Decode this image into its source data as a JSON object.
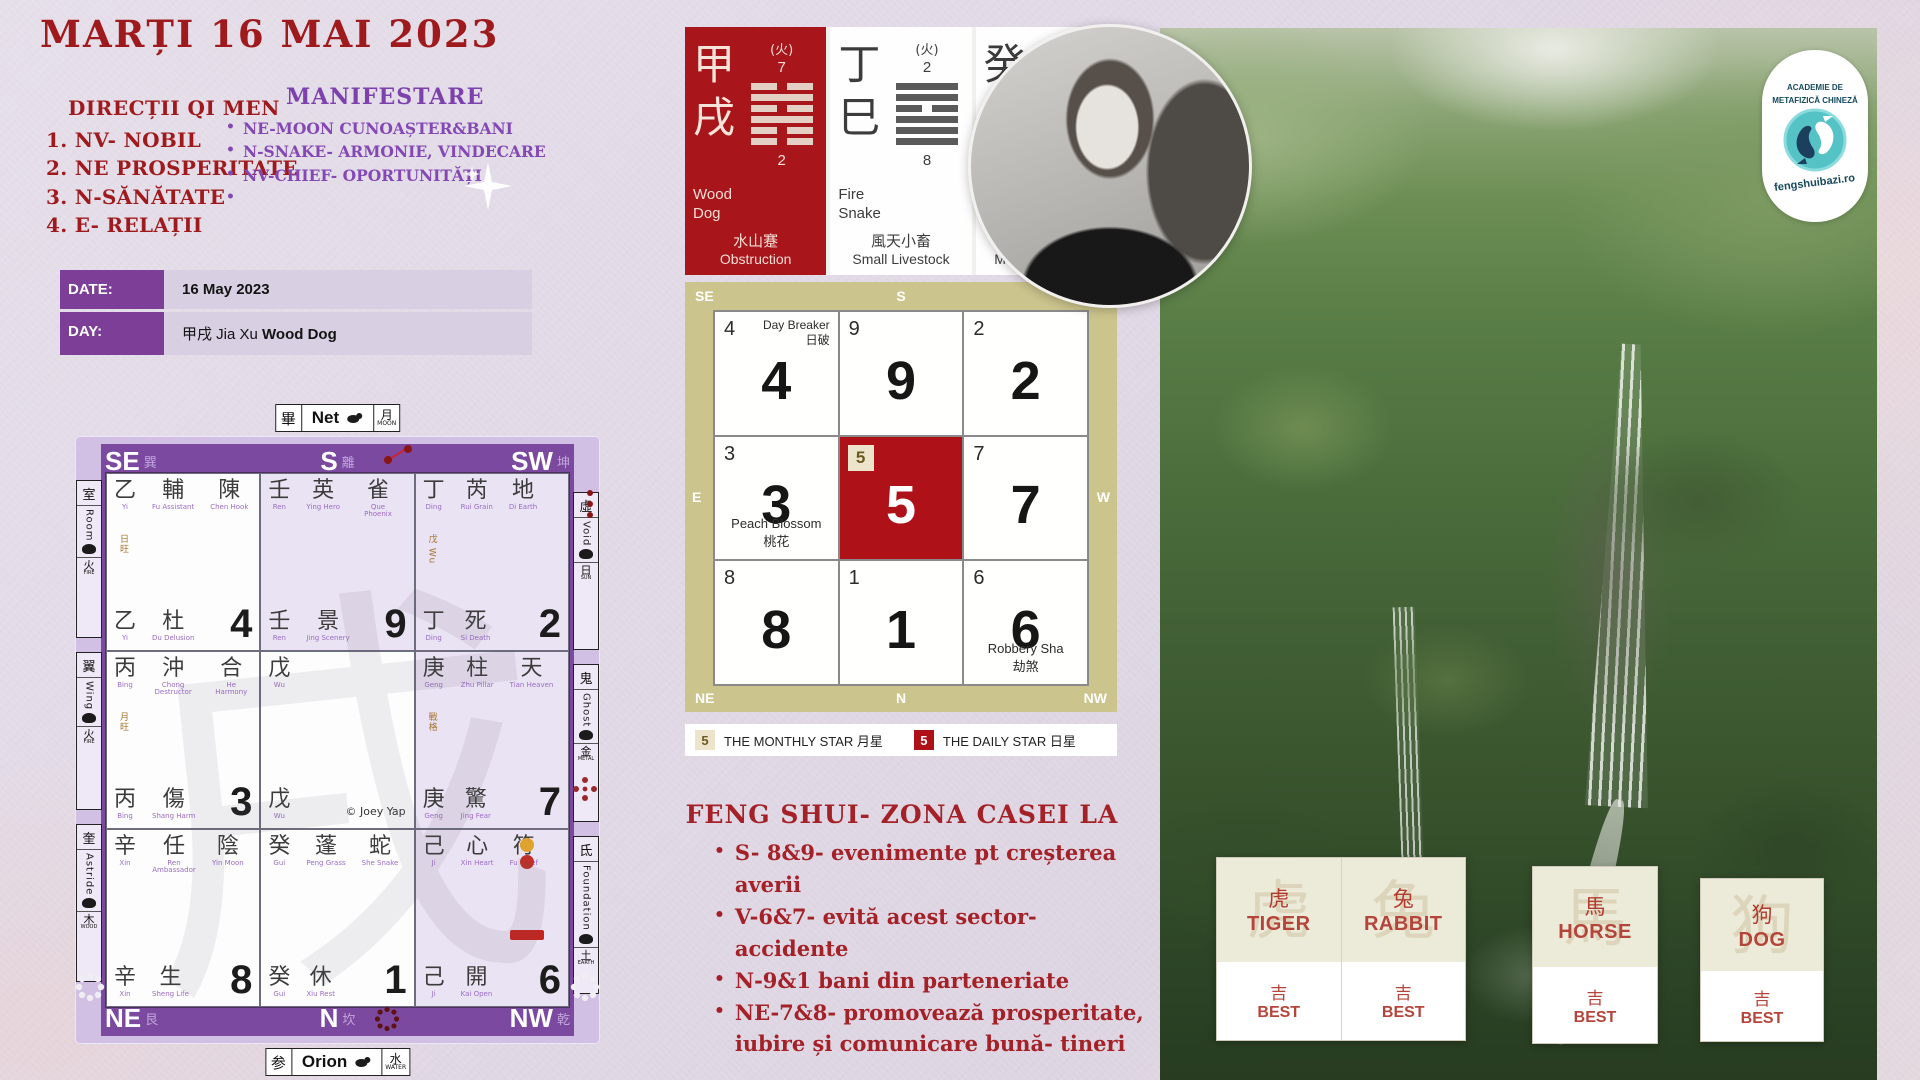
{
  "page": {
    "title": "MARȚI 16  MAI 2023"
  },
  "directions": {
    "heading": "DIRECȚII QI MEN",
    "items": [
      "1. NV- NOBIL",
      "2. NE PROSPERITATE",
      "3. N-SĂNĂTATE",
      "4. E- RELAȚII"
    ]
  },
  "manifestare": {
    "heading": "MANIFESTARE",
    "items": [
      "NE-MOON CUNOAȘTER&BANI",
      "N-SNAKE- ARMONIE, VINDECARE",
      "NV-CHIEF- OPORTUNITĂȚI",
      ""
    ]
  },
  "date_table": {
    "rows": [
      {
        "label": "DATE:",
        "segments": [
          {
            "text": "16 May 2023",
            "bold": true
          }
        ]
      },
      {
        "label": "DAY:",
        "segments": [
          {
            "text": "甲戌 Jia Xu ",
            "bold": false
          },
          {
            "text": "Wood Dog",
            "bold": true
          }
        ]
      }
    ]
  },
  "pillars": [
    {
      "theme": "red",
      "zh1": "甲",
      "zh2": "戌",
      "element": "(火)",
      "top_num": "7",
      "bottom_num": "2",
      "name1": "Wood",
      "name2": "Dog",
      "hex_zh": "水山蹇",
      "hex_en": "Obstruction",
      "lines": [
        "broken",
        "solid",
        "broken",
        "solid",
        "broken",
        "broken"
      ]
    },
    {
      "theme": "white",
      "zh1": "丁",
      "zh2": "巳",
      "element": "(火)",
      "top_num": "2",
      "bottom_num": "8",
      "name1": "Fire",
      "name2": "Snake",
      "hex_zh": "風天小畜",
      "hex_en": "Small Livestock",
      "lines": [
        "solid",
        "solid",
        "broken",
        "solid",
        "solid",
        "solid"
      ]
    },
    {
      "theme": "white",
      "zh1": "癸",
      "zh2": "卯",
      "element": "(木)",
      "top_num": "8",
      "bottom_num": "7",
      "name1": "Water",
      "name2": "Rabbit",
      "hex_zh": "雷澤歸妹",
      "hex_en": "Marrying Maiden",
      "lines": [
        "broken",
        "broken",
        "solid",
        "broken",
        "solid",
        "solid"
      ]
    }
  ],
  "qimen": {
    "top_label": {
      "star": "畢",
      "name": "Net",
      "element": "月",
      "element_en": "MOON"
    },
    "bottom_label": {
      "star": "参",
      "name": "Orion",
      "element": "水",
      "element_en": "WATER"
    },
    "header": [
      {
        "dir": "SE",
        "trigram": "巽"
      },
      {
        "dir": "S",
        "trigram": "離"
      },
      {
        "dir": "SW",
        "trigram": "坤"
      }
    ],
    "footer": [
      {
        "dir": "NE",
        "trigram": "艮"
      },
      {
        "dir": "N",
        "trigram": "坎"
      },
      {
        "dir": "NW",
        "trigram": "乾"
      }
    ],
    "side_dirs": {
      "e": {
        "dir": "E",
        "trigram": "震"
      },
      "w": {
        "dir": "W",
        "trigram": "兌"
      }
    },
    "side_left": [
      {
        "zh": "室",
        "en": "Room",
        "element": "火",
        "element_en": "FIRE"
      },
      {
        "zh": "翼",
        "en": "Wing",
        "element": "火",
        "element_en": "FIRE"
      },
      {
        "zh": "奎",
        "en": "Astride",
        "element": "木",
        "element_en": "WOOD"
      }
    ],
    "side_right": [
      {
        "zh": "虛",
        "en": "Void",
        "element": "日",
        "element_en": "SUN"
      },
      {
        "zh": "鬼",
        "en": "Ghost",
        "element": "金",
        "element_en": "METAL"
      },
      {
        "zh": "氐",
        "en": "Foundation",
        "element": "土",
        "element_en": "EARTH"
      }
    ],
    "watermark": "戌",
    "copyright": "© Joey Yap",
    "cells": [
      {
        "pos": "SE",
        "bg": "white",
        "top": [
          {
            "zh": "乙",
            "sub": "Yi"
          },
          {
            "zh": "輔",
            "sub": "Fu Assistant"
          },
          {
            "zh": "陳",
            "sub": "Chen Hook"
          }
        ],
        "note": "日旺",
        "bottom": [
          {
            "zh": "乙",
            "sub": "Yi"
          },
          {
            "zh": "杜",
            "sub": "Du Delusion"
          }
        ],
        "num": "4"
      },
      {
        "pos": "S",
        "bg": "lav",
        "top": [
          {
            "zh": "壬",
            "sub": "Ren"
          },
          {
            "zh": "英",
            "sub": "Ying Hero"
          },
          {
            "zh": "雀",
            "sub": "Que Phoenix"
          }
        ],
        "bottom": [
          {
            "zh": "壬",
            "sub": "Ren"
          },
          {
            "zh": "景",
            "sub": "Jing Scenery"
          }
        ],
        "num": "9"
      },
      {
        "pos": "SW",
        "bg": "lav",
        "top": [
          {
            "zh": "丁",
            "sub": "Ding"
          },
          {
            "zh": "芮",
            "sub": "Rui Grain"
          },
          {
            "zh": "地",
            "sub": "Di Earth"
          }
        ],
        "note": "戊 Wu",
        "bottom": [
          {
            "zh": "丁",
            "sub": "Ding"
          },
          {
            "zh": "死",
            "sub": "Si Death"
          }
        ],
        "num": "2"
      },
      {
        "pos": "E",
        "bg": "white",
        "top": [
          {
            "zh": "丙",
            "sub": "Bing"
          },
          {
            "zh": "沖",
            "sub": "Chong Destructor"
          },
          {
            "zh": "合",
            "sub": "He Harmony"
          }
        ],
        "note": "月旺",
        "bottom": [
          {
            "zh": "丙",
            "sub": "Bing"
          },
          {
            "zh": "傷",
            "sub": "Shang Harm"
          }
        ],
        "num": "3"
      },
      {
        "pos": "C",
        "bg": "white",
        "top": [
          {
            "zh": "戊",
            "sub": "Wu"
          }
        ],
        "bottom": [
          {
            "zh": "戊",
            "sub": "Wu"
          }
        ],
        "num": "",
        "copyright": true
      },
      {
        "pos": "W",
        "bg": "lav",
        "top": [
          {
            "zh": "庚",
            "sub": "Geng"
          },
          {
            "zh": "柱",
            "sub": "Zhu Pillar"
          },
          {
            "zh": "天",
            "sub": "Tian Heaven"
          }
        ],
        "note": "戰格",
        "bottom": [
          {
            "zh": "庚",
            "sub": "Geng"
          },
          {
            "zh": "驚",
            "sub": "Jing Fear"
          }
        ],
        "num": "7"
      },
      {
        "pos": "NE",
        "bg": "white",
        "top": [
          {
            "zh": "辛",
            "sub": "Xin"
          },
          {
            "zh": "任",
            "sub": "Ren Ambassador"
          },
          {
            "zh": "陰",
            "sub": "Yin Moon"
          }
        ],
        "bottom": [
          {
            "zh": "辛",
            "sub": "Xin"
          },
          {
            "zh": "生",
            "sub": "Sheng Life"
          }
        ],
        "num": "8"
      },
      {
        "pos": "N",
        "bg": "white",
        "top": [
          {
            "zh": "癸",
            "sub": "Gui"
          },
          {
            "zh": "蓬",
            "sub": "Peng Grass"
          },
          {
            "zh": "蛇",
            "sub": "She Snake"
          }
        ],
        "bottom": [
          {
            "zh": "癸",
            "sub": "Gui"
          },
          {
            "zh": "休",
            "sub": "Xiu Rest"
          }
        ],
        "num": "1"
      },
      {
        "pos": "NW",
        "bg": "lav",
        "top": [
          {
            "zh": "己",
            "sub": "Ji"
          },
          {
            "zh": "心",
            "sub": "Xin Heart"
          },
          {
            "zh": "符",
            "sub": "Fu Chief"
          }
        ],
        "badges": [
          "#e0a32e",
          "#c03028"
        ],
        "tag": true,
        "bottom": [
          {
            "zh": "己",
            "sub": "Ji"
          },
          {
            "zh": "開",
            "sub": "Kai Open"
          }
        ],
        "num": "6"
      }
    ]
  },
  "flying_star": {
    "dirs": {
      "se": "SE",
      "s": "S",
      "sw": "SW",
      "e": "E",
      "w": "W",
      "ne": "NE",
      "n": "N",
      "nw": "NW"
    },
    "cells": [
      {
        "small": "4",
        "big": "4",
        "note_en": "Day Breaker",
        "note_zh": "日破",
        "note_pos": "top"
      },
      {
        "small": "9",
        "big": "9"
      },
      {
        "small": "2",
        "big": "2"
      },
      {
        "small": "3",
        "big": "3",
        "note_en": "Peach Blossom",
        "note_zh": "桃花",
        "note_pos": "bottom"
      },
      {
        "small": "5",
        "big": "5",
        "center": true
      },
      {
        "small": "7",
        "big": "7"
      },
      {
        "small": "8",
        "big": "8"
      },
      {
        "small": "1",
        "big": "1"
      },
      {
        "small": "6",
        "big": "6",
        "note_en": "Robbery Sha",
        "note_zh": "劫煞",
        "note_pos": "bottom"
      }
    ]
  },
  "legend": {
    "monthly_num": "5",
    "monthly_label": "THE MONTHLY STAR 月星",
    "daily_num": "5",
    "daily_label": "THE DAILY STAR 日星"
  },
  "zone": {
    "heading": "FENG SHUI- ZONA CASEI LA",
    "items": [
      "S- 8&9- evenimente pt creșterea averii",
      "V-6&7- evită acest sector- accidente",
      "N-9&1 bani din parteneriate",
      "NE-7&8- promovează prosperitate, iubire și  comunicare bună- tineri"
    ]
  },
  "logo": {
    "line1": "ACADEMIE DE",
    "line2": "METAFIZICĂ CHINEZĂ",
    "url": "fengshuibazi.ro"
  },
  "animals": {
    "items": [
      {
        "zh": "虎",
        "en": "TIGER",
        "luck_zh": "吉",
        "luck_en": "BEST"
      },
      {
        "zh": "兔",
        "en": "RABBIT",
        "luck_zh": "吉",
        "luck_en": "BEST"
      },
      {
        "zh": "馬",
        "en": "HORSE",
        "luck_zh": "吉",
        "luck_en": "BEST"
      },
      {
        "zh": "狗",
        "en": "DOG",
        "luck_zh": "吉",
        "luck_en": "BEST"
      }
    ]
  },
  "colors": {
    "accent_red": "#9e1a1d",
    "accent_purple": "#7d41ae",
    "star_red": "#ae1117",
    "khaki": "#ccc48d"
  }
}
